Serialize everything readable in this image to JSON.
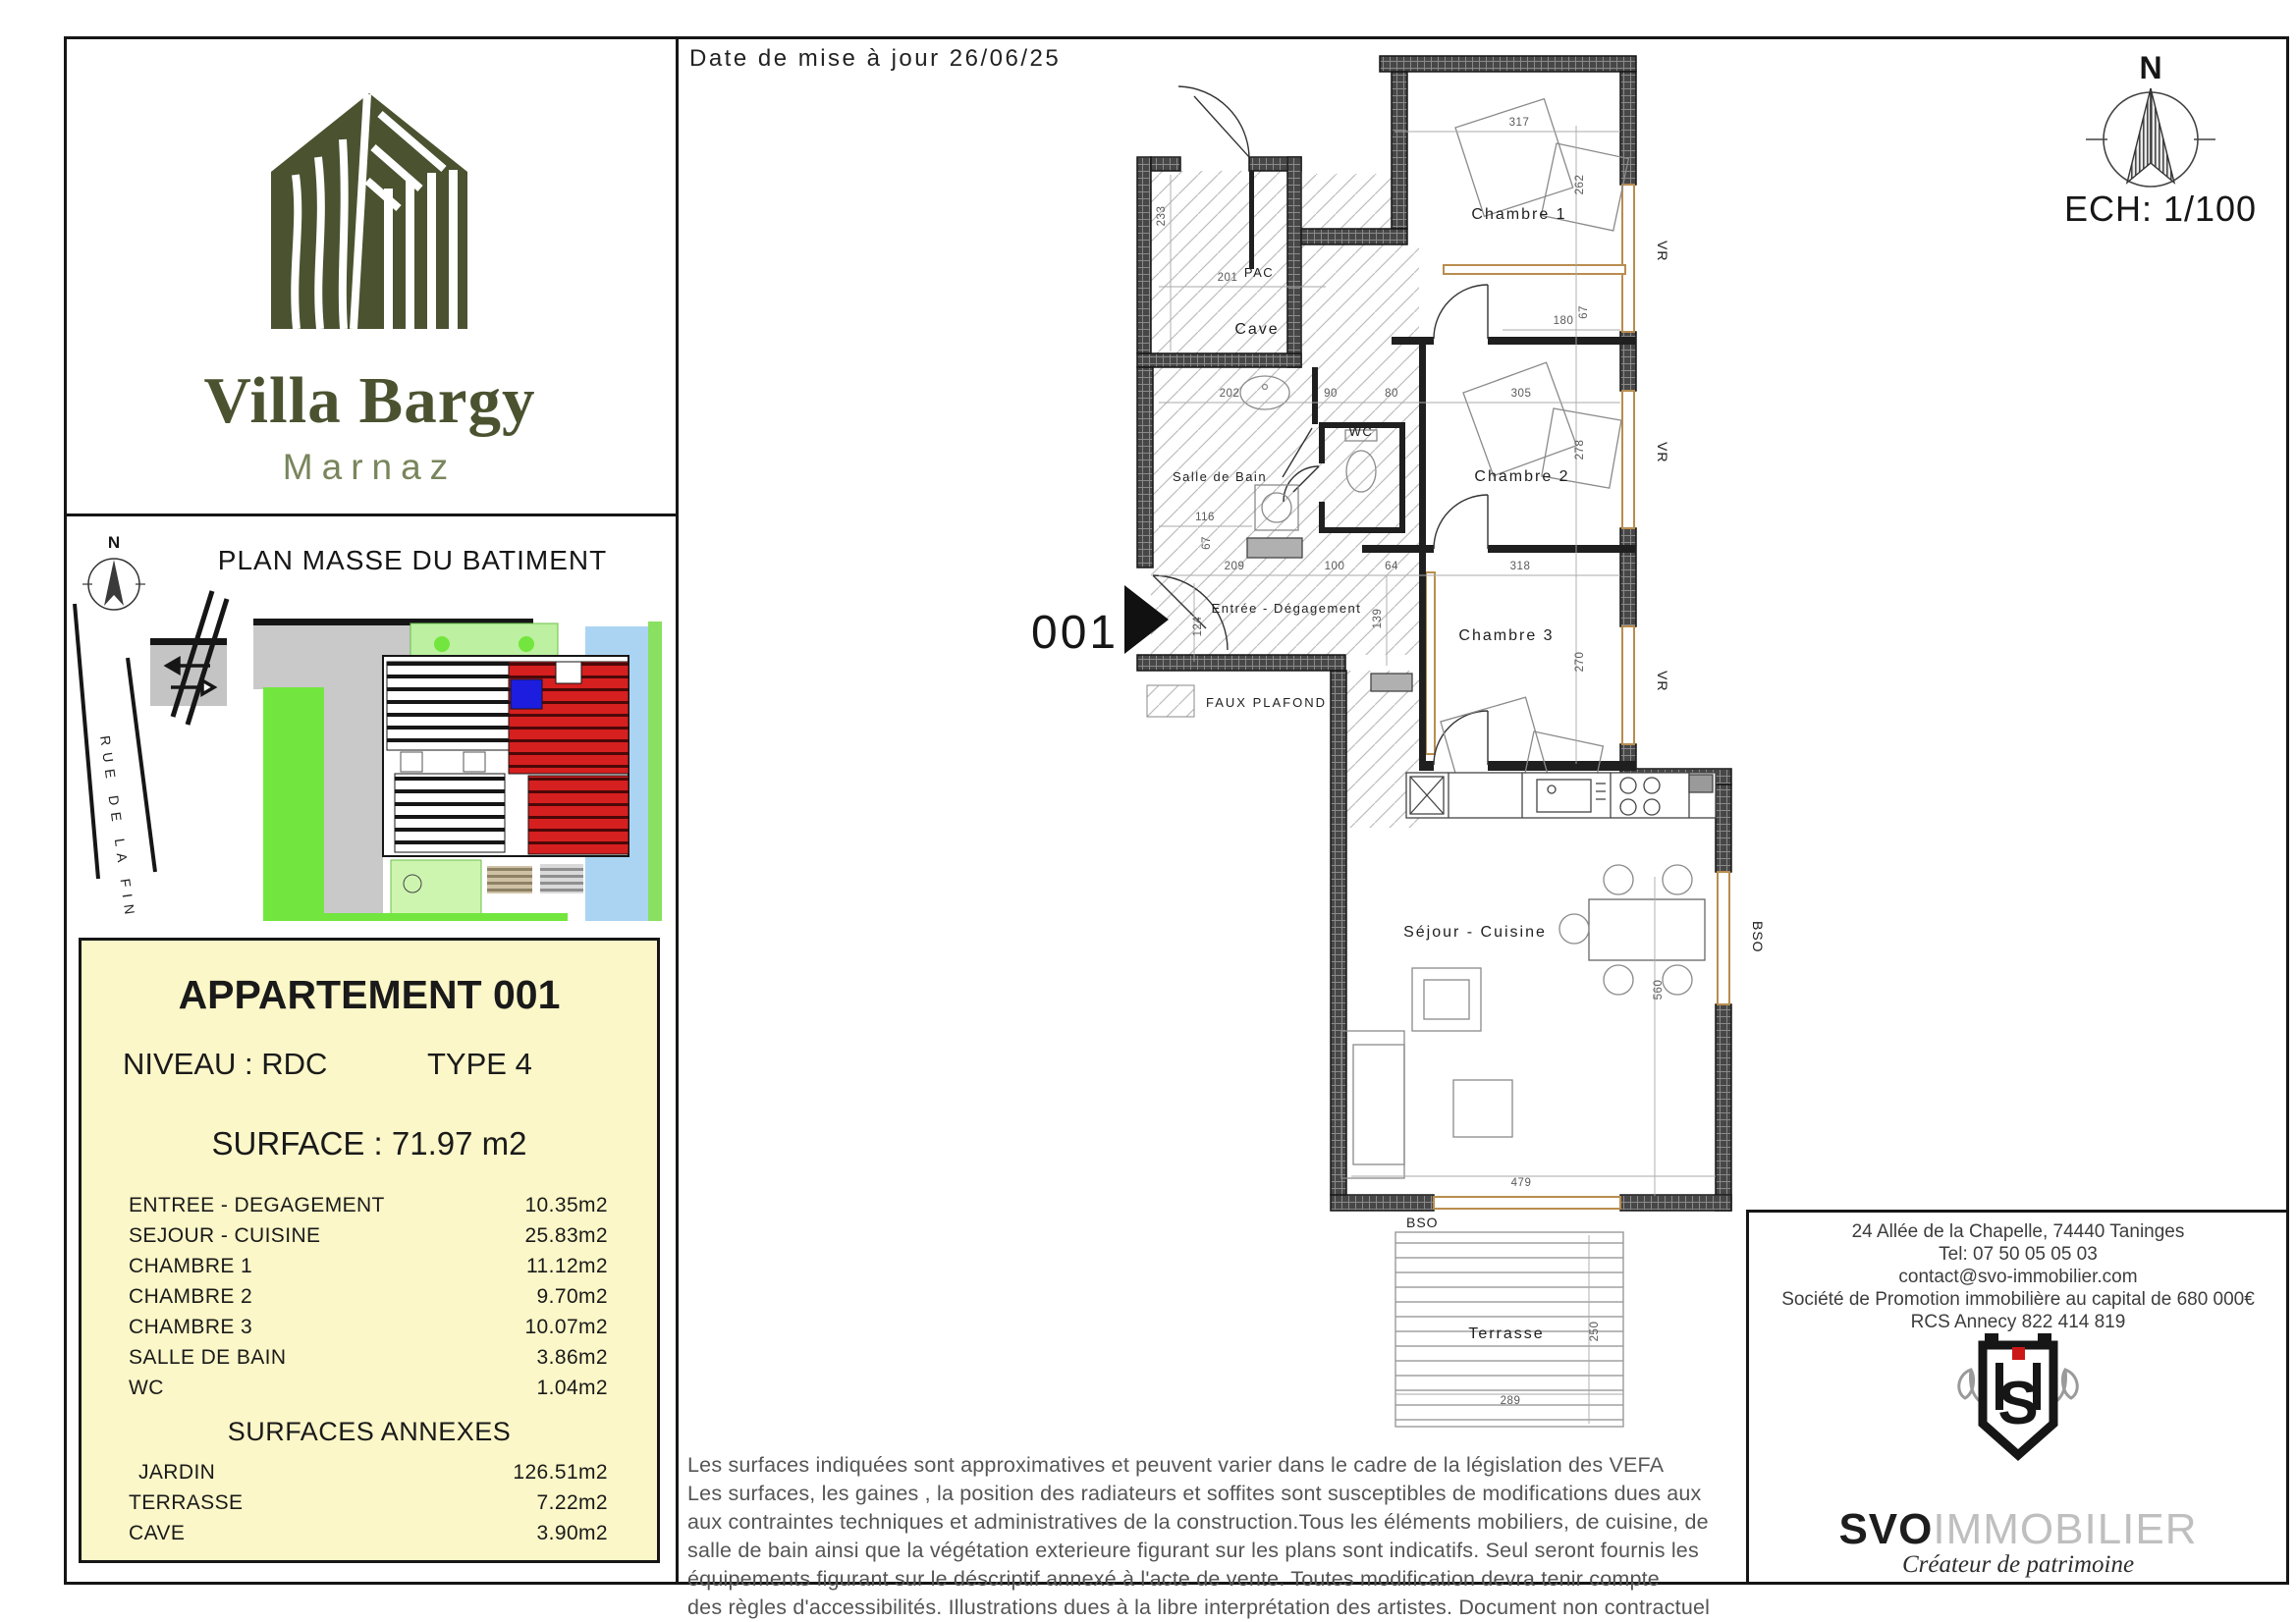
{
  "header": {
    "date_label": "Date de mise à jour 26/06/25",
    "scale_label": "ECH: 1/100",
    "north_label": "N"
  },
  "brand": {
    "name": "Villa Bargy",
    "city": "Marnaz"
  },
  "site_plan": {
    "title": "PLAN MASSE DU BATIMENT",
    "street": "RUE DE LA FIN",
    "north_label": "N"
  },
  "apartment": {
    "title": "APPARTEMENT 001",
    "level_label": "NIVEAU : RDC",
    "type_label": "TYPE 4",
    "surface_label": "SURFACE : 71.97 m2",
    "rooms": [
      {
        "label": "ENTREE - DEGAGEMENT",
        "area": "10.35m2"
      },
      {
        "label": "SEJOUR - CUISINE",
        "area": "25.83m2"
      },
      {
        "label": "CHAMBRE 1",
        "area": "11.12m2"
      },
      {
        "label": "CHAMBRE 2",
        "area": "9.70m2"
      },
      {
        "label": "CHAMBRE 3",
        "area": "10.07m2"
      },
      {
        "label": "SALLE DE BAIN",
        "area": "3.86m2"
      },
      {
        "label": "WC",
        "area": "1.04m2"
      }
    ],
    "annexes_title": "SURFACES ANNEXES",
    "annexes": [
      {
        "label": "JARDIN",
        "area": "126.51m2"
      },
      {
        "label": "TERRASSE",
        "area": "7.22m2"
      },
      {
        "label": "CAVE",
        "area": "3.90m2"
      }
    ]
  },
  "plan": {
    "unit_number": "001",
    "rooms": {
      "cave": "Cave",
      "pac": "PAC",
      "chambre1": "Chambre 1",
      "chambre2": "Chambre 2",
      "chambre3": "Chambre 3",
      "wc": "WC",
      "sdb": "Salle de Bain",
      "entree": "Entrée - Dégagement",
      "sejour": "Séjour - Cuisine",
      "terrasse": "Terrasse"
    },
    "legend": {
      "faux_plafond": "FAUX PLAFOND"
    },
    "window_labels": {
      "vr": "VR",
      "bso": "BSO"
    },
    "dims": [
      "233",
      "201",
      "317",
      "262",
      "180",
      "67",
      "202",
      "90",
      "80",
      "305",
      "278",
      "116",
      "67",
      "209",
      "100",
      "64",
      "318",
      "124",
      "139",
      "270",
      "560",
      "479",
      "289",
      "250"
    ]
  },
  "disclaimer": "Les surfaces indiquées sont approximatives et peuvent varier dans le cadre de la législation des VEFA\nLes surfaces, les gaines , la position des radiateurs et soffites sont susceptibles de modifications dues aux\naux contraintes techniques et administratives de la construction.Tous les éléments mobiliers, de cuisine, de\nsalle de bain ainsi que la  végétation  exterieure figurant sur les plans sont indicatifs. Seul seront fournis les\néquipements figurant sur le déscriptif annexé à l'acte de vente. Toutes modification devra tenir compte\ndes règles d'accessibilités. Illustrations dues à la libre interprétation des artistes. Document non contractuel",
  "agency": {
    "address": "24 Allée de la Chapelle, 74440 Taninges",
    "tel": "Tel: 07 50 05 05 03",
    "email": "contact@svo-immobilier.com",
    "company": "Société de Promotion immobilière au capital de 680 000€",
    "rcs": "RCS Annecy 822 414 819",
    "logo_name": "SVO",
    "logo_suffix": "IMMOBILIER",
    "monogram": "S",
    "tagline": "Créateur de patrimoine"
  }
}
